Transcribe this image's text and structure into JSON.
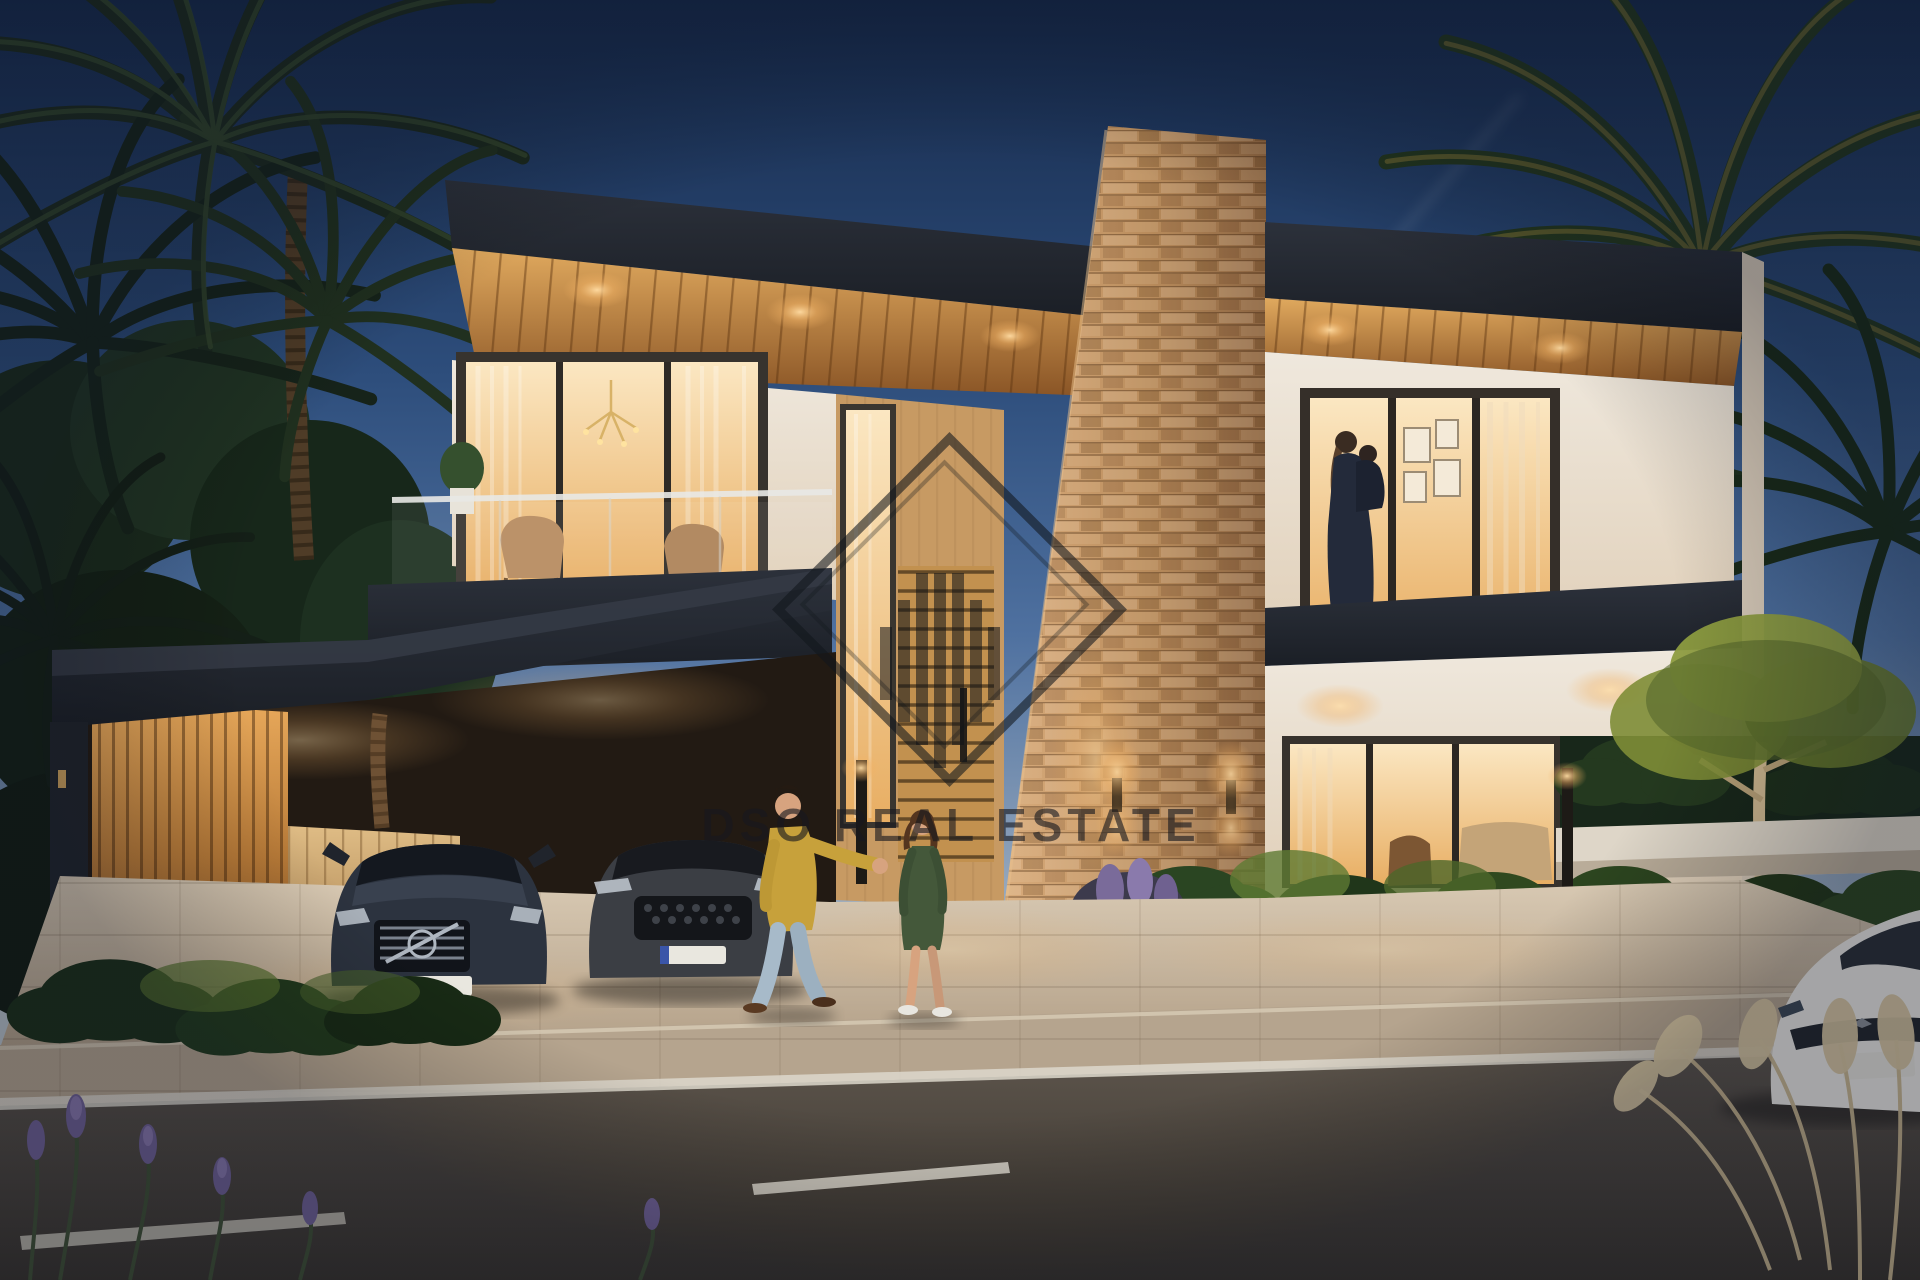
{
  "watermark": {
    "text": "DSO REAL ESTATE",
    "logo": "diamond-skyline-icon"
  },
  "scene": {
    "type": "architectural-render",
    "time_of_day": "dusk",
    "subject": "modern two-storey villa with carport, stone feature column, palm trees, two parked SUVs, couple walking, white car on street",
    "colors": {
      "sky_top": "#16294a",
      "sky_horizon": "#b9c2c9",
      "roof_fascia": "#252a33",
      "soffit_wood": "#c08a47",
      "wall_cream": "#ece3d6",
      "stone": "#c09468",
      "window_glow": "#f3cf9e",
      "driveway": "#cdbda6",
      "road": "#4a443d",
      "watermark_ink": "#16191f",
      "sweater_yellow": "#c7a13b",
      "dress_green": "#44583a"
    }
  }
}
